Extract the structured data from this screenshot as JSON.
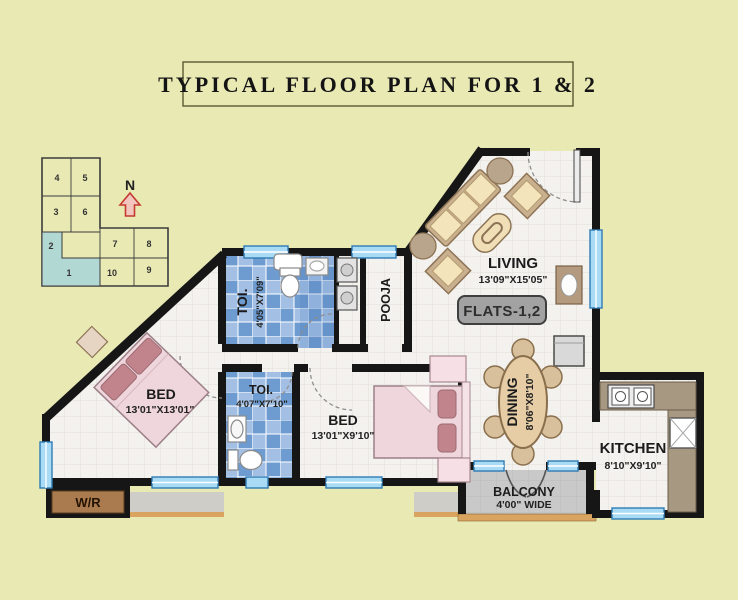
{
  "title": "TYPICAL FLOOR PLAN FOR 1 & 2",
  "badge": {
    "label": "FLATS-1,2"
  },
  "key_plan": {
    "north_label": "N",
    "units": [
      "4",
      "5",
      "3",
      "6",
      "2",
      "1",
      "7",
      "8",
      "10",
      "9"
    ],
    "highlighted_units": [
      "1",
      "2"
    ]
  },
  "rooms": {
    "living": {
      "label": "LIVING",
      "dim": "13'09\"X15'05\""
    },
    "pooja": {
      "label": "POOJA"
    },
    "toilet_top": {
      "label": "TOI.",
      "dim": "4'05\"X7'09\""
    },
    "toilet_mid": {
      "label": "TOI.",
      "dim": "4'07\"X7'10\""
    },
    "bed_left": {
      "label": "BED",
      "dim": "13'01\"X13'01\""
    },
    "bed_mid": {
      "label": "BED",
      "dim": "13'01\"X9'10\""
    },
    "dining": {
      "label": "DINING",
      "dim": "8'06\"X8'10\""
    },
    "kitchen": {
      "label": "KITCHEN",
      "dim": "8'10\"X9'10\""
    },
    "balcony": {
      "label": "BALCONY",
      "dim": "4'00\" WIDE"
    },
    "wardrobe": {
      "label": "W/R"
    }
  },
  "colors": {
    "background": "#e9e9b4",
    "wall": "#161616",
    "floor": "#f4f2ee",
    "bath_tile": "#6f9cd0",
    "window": "#a9dbf4",
    "bed_pink": "#efd5dc",
    "furniture_tan": "#c9b08e",
    "highlight_teal": "#b2d8d3",
    "balcony_gray": "#c9c9c9",
    "ledge_tan": "#d9a45f",
    "wr_brown": "#aa7b4e",
    "badge_gray": "#a2a2a2"
  }
}
